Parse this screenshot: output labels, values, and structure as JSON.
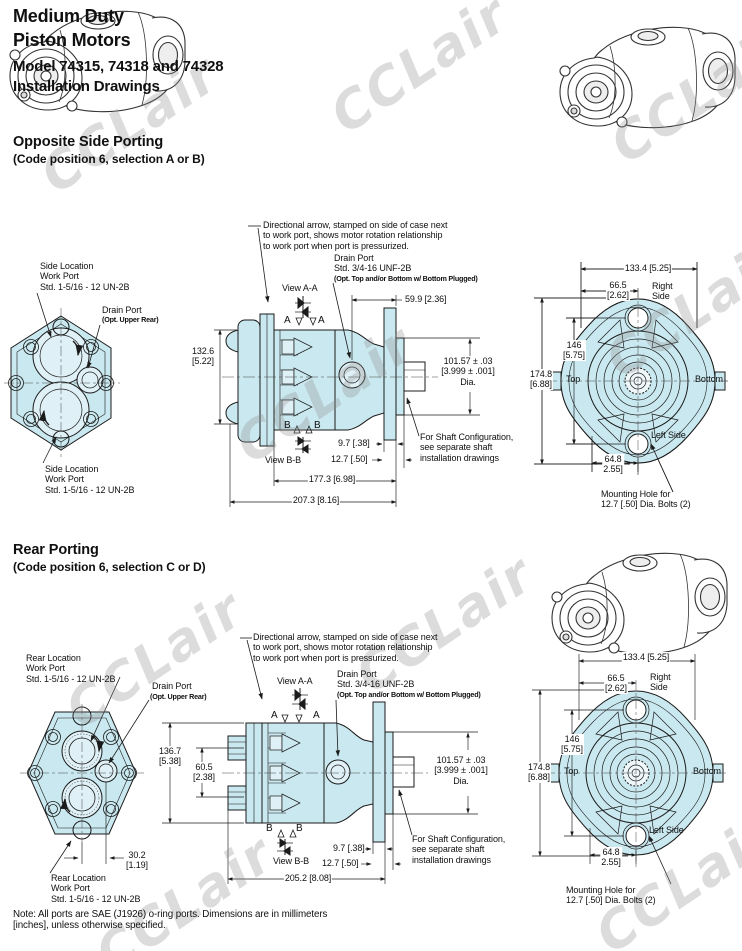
{
  "header": {
    "title1": "Medium Duty",
    "title2": "Piston Motors",
    "subtitle1": "Model 74315, 74318 and 74328",
    "subtitle2": "Installation Drawings"
  },
  "watermark": "CCLair",
  "colors": {
    "drawing_fill": "#c9e8ef",
    "line": "#1b1b1b",
    "watermark": "#8f8f8f"
  },
  "footnote": "Note:  All ports are SAE (J1926) o-ring ports.  Dimensions are in millimeters\n[inches], unless otherwise specified.",
  "flange_view": {
    "dim_133": "133.4 [5.25]",
    "dim_66": "66.5\n[2.62]",
    "right_side": "Right\nSide",
    "dim_146": "146\n[5.75]",
    "dim_174": "174.8\n[6.88]",
    "top": "Top",
    "bottom": "Bottom",
    "left_side": "Left Side",
    "dim_64": "64.8\n2.55]",
    "mounting_note": "Mounting Hole for\n12.7 [.50] Dia. Bolts (2)"
  },
  "s1": {
    "heading": "Opposite Side Porting",
    "subheading": "(Code position 6, selection A or B)",
    "directional_note": "Directional arrow, stamped on side of case next\nto work port, shows motor rotation relationship\nto work port when port is pressurized.",
    "drain_port_title": "Drain Port",
    "drain_port_spec": "Std. 3/4-16 UNF-2B",
    "drain_port_opt": "(Opt. Top and/or Bottom w/ Bottom Plugged)",
    "side_port_label": "Side Location\nWork Port\nStd. 1-5/16 - 12 UN-2B",
    "drain_left_title": "Drain Port",
    "drain_left_opt": "(Opt. Upper Rear)",
    "view_aa": "View A-A",
    "view_bb": "View B-B",
    "letter_a": "A",
    "letter_b": "B",
    "dim_59": "59.9 [2.36]",
    "dim_132": "132.6\n[5.22]",
    "dim_101": "101.57 ± .03\n[3.999 ± .001]\nDia.",
    "shaft_note": "For Shaft Configuration,\nsee separate shaft\ninstallation drawings",
    "dim_97": "9.7 [.38]",
    "dim_127": "12.7 [.50]",
    "dim_177": "177.3 [6.98]",
    "dim_207": "207.3 [8.16]"
  },
  "s2": {
    "heading": "Rear Porting",
    "subheading": "(Code position 6, selection C or D)",
    "directional_note": "Directional arrow, stamped on side of case next\nto work port, shows motor rotation relationship\nto work port when port is pressurized.",
    "drain_port_title": "Drain Port",
    "drain_port_spec": "Std. 3/4-16 UNF-2B",
    "drain_port_opt": "(Opt. Top and/or Bottom w/ Bottom Plugged)",
    "rear_port_label": "Rear Location\nWork Port\nStd. 1-5/16 - 12 UN-2B",
    "drain_left_title": "Drain Port",
    "drain_left_opt": "(Opt. Upper Rear)",
    "view_aa": "View A-A",
    "view_bb": "View B-B",
    "letter_a": "A",
    "letter_b": "B",
    "dim_136": "136.7\n[5.38]",
    "dim_60": "60.5\n[2.38]",
    "dim_30": "30.2\n[1.19]",
    "dim_101": "101.57 ± .03\n[3.999 ± .001]\nDia.",
    "shaft_note": "For Shaft Configuration,\nsee separate shaft\ninstallation drawings",
    "dim_97": "9.7 [.38]",
    "dim_127": "12.7 [.50]",
    "dim_205": "205.2 [8.08]"
  }
}
